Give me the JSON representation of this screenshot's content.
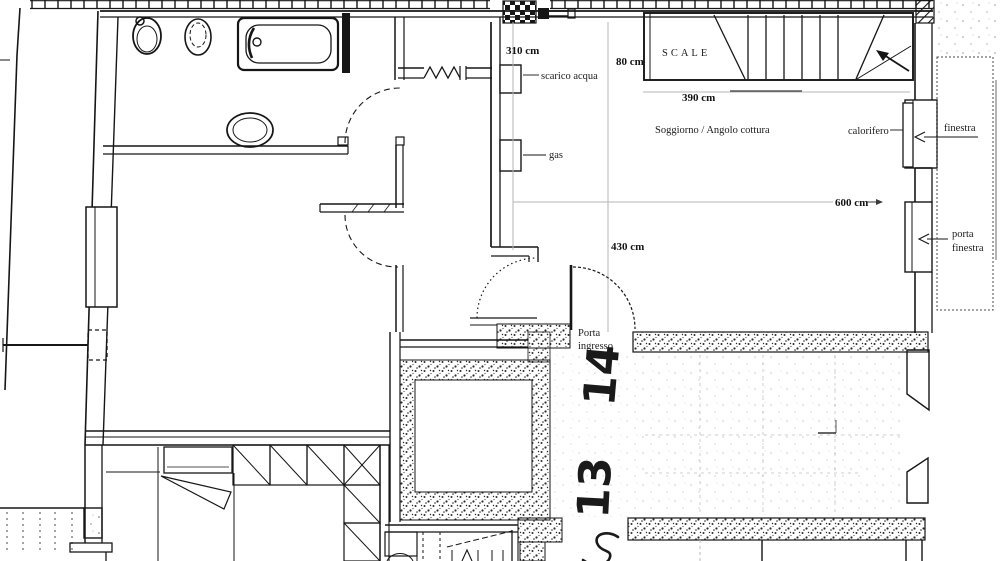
{
  "colors": {
    "paper": "#ffffff",
    "ink": "#161616",
    "dim_line": "#b5b5b5",
    "ghost_line": "#cfcfcf",
    "stipple": "#2a2a2a"
  },
  "labels": {
    "scarico_acqua": "scarico acqua",
    "gas": "gas",
    "scale": "SCALE",
    "soggiorno": "Soggiorno / Angolo cottura",
    "calorifero": "calorifero",
    "finestra": "finestra",
    "porta_finestra_line1": "porta",
    "porta_finestra_line2": "finestra",
    "porta_ingresso_line1": "Porta",
    "porta_ingresso_line2": "ingresso"
  },
  "dimensions": {
    "bath_width": "310 cm",
    "stair_width": "80 cm",
    "stair_length": "390 cm",
    "room_length": "600 cm",
    "room_width": "430 cm"
  },
  "handwritten": {
    "room_number_14": "14",
    "room_number_13": "13"
  }
}
